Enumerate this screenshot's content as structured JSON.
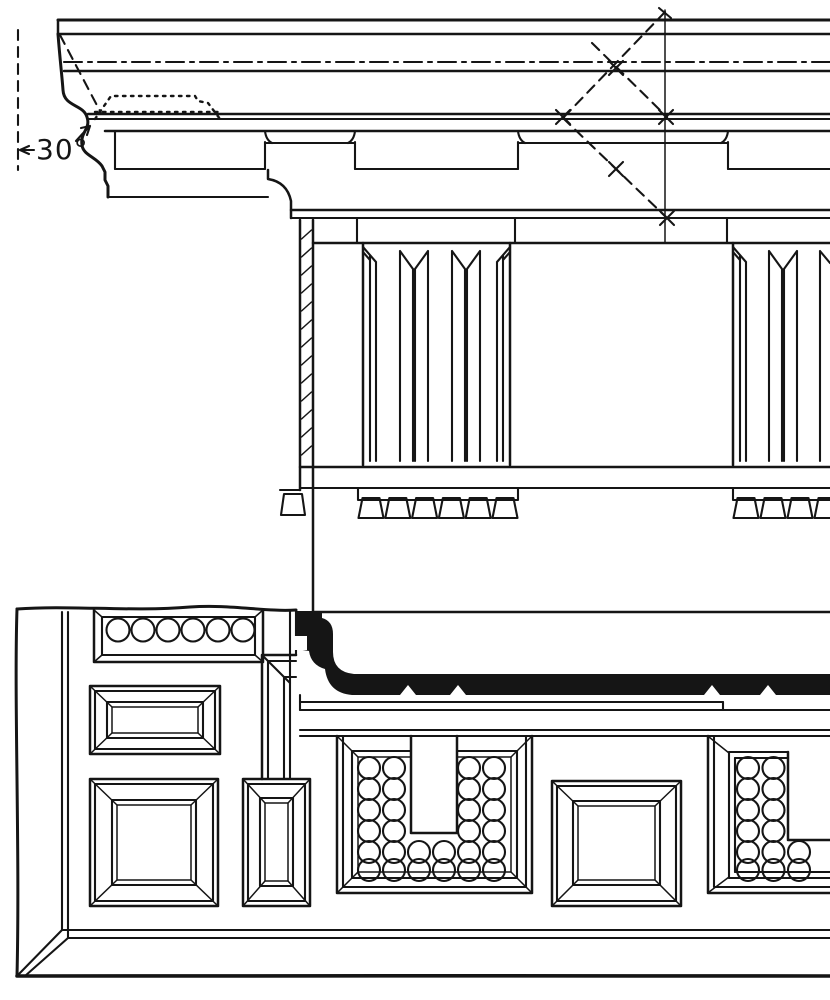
{
  "figure": {
    "subject": "Doric entablature plate: cornice section and elevation above, reflected soffit plan below",
    "ink_color": "#151515",
    "paper_color": "#ffffff"
  },
  "annotations": {
    "angle_label": "30°"
  },
  "counts": {
    "strip_guttae": 6,
    "regula_guttae": 6,
    "regula2_guttae_visible": 4,
    "mutule_grid_rows": 6,
    "mutule_grid_cols": 6,
    "right_mutule_cols_top": 2,
    "right_mutule_cols_bottom": 3
  }
}
